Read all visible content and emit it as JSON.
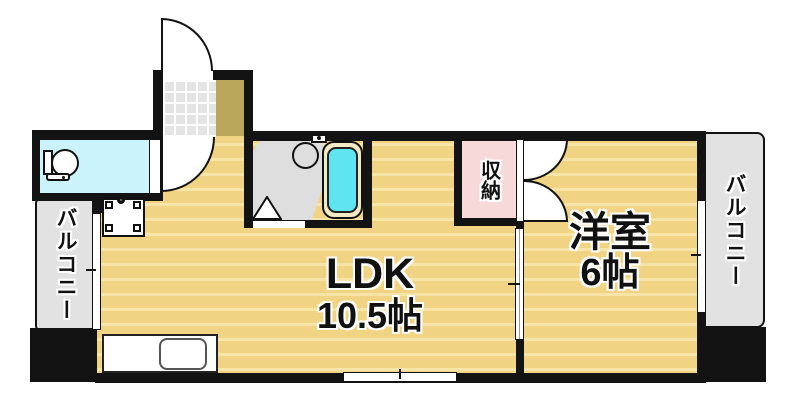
{
  "colors": {
    "wall": "#131313",
    "floor": "#F0D383",
    "floor_line": "#F7E4A8",
    "hall": "#BBA75C",
    "tile": "#E4E4E4",
    "wet_floor": "#DEDEDE",
    "balcony": "#E2E2E2",
    "toilet": "#CBF3FB",
    "bathtub": "#5FE5F2",
    "tub_rim": "#F2E9C5",
    "storage": "#F8D9DA"
  },
  "rooms": {
    "ldk": {
      "name": "LDK",
      "size": "10.5帖"
    },
    "western_room": {
      "name": "洋室",
      "size": "6帖"
    },
    "storage": {
      "name": "収納"
    },
    "balcony_left": {
      "name": "バルコニー"
    },
    "balcony_right": {
      "name": "バルコニー"
    }
  }
}
